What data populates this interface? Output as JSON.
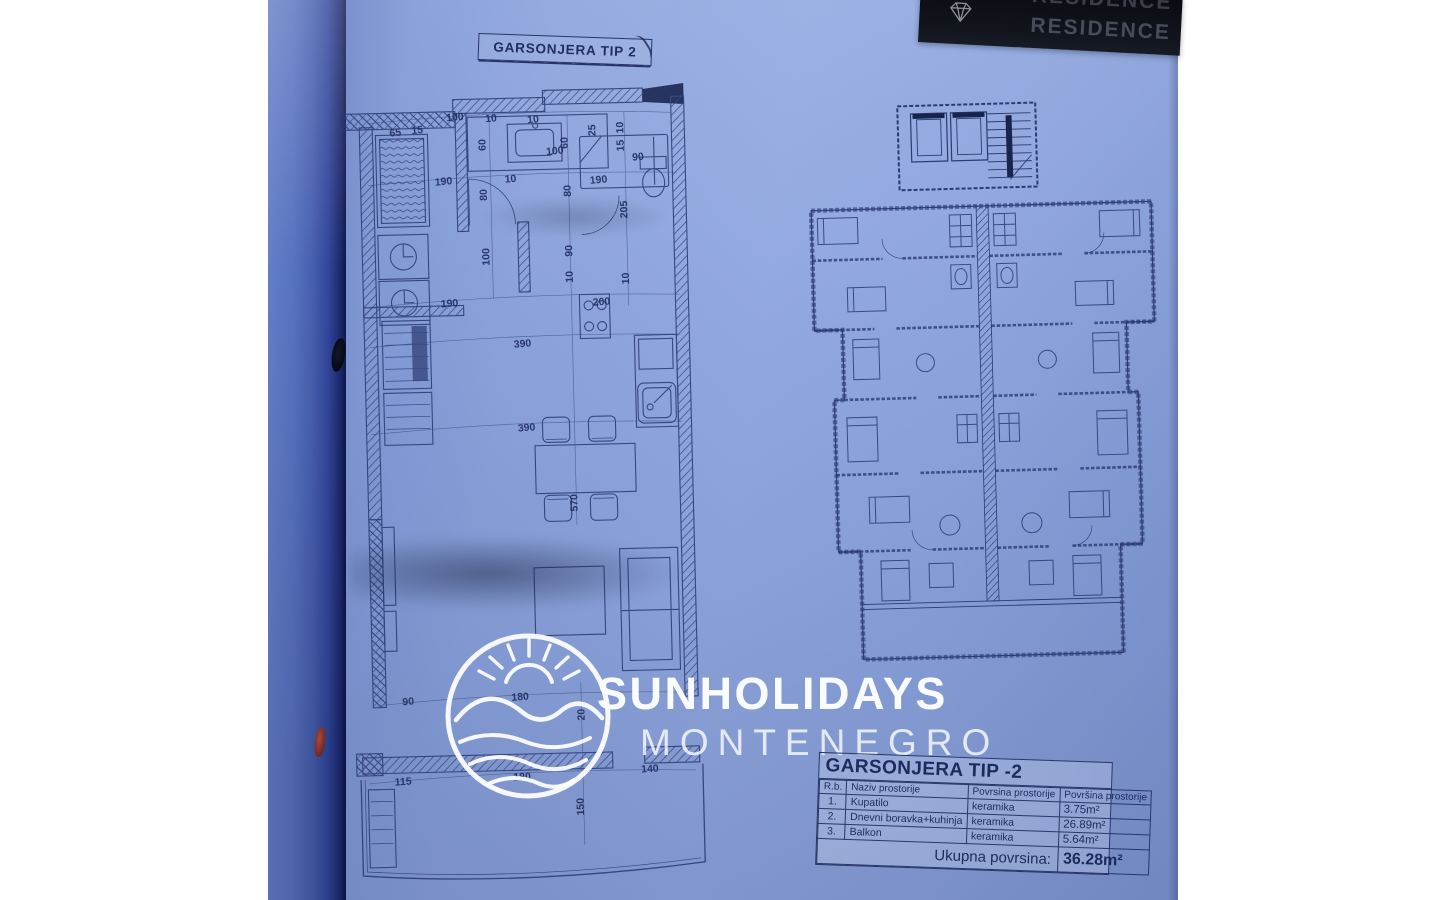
{
  "colors": {
    "page_blue": "#8aa2dc",
    "ink": "#2c3b72",
    "spine_dark": "#0c143f",
    "banner_bg": "#0a0c11",
    "banner_text": "#464c59",
    "watermark_white": "#ffffff",
    "red_mark": "#7c2a1d"
  },
  "banner": {
    "text": "RESIDENCE",
    "icon": "gem-icon"
  },
  "plan_title": {
    "text": "GARSONJERA TIP 2"
  },
  "watermark": {
    "line1": "SUNHOLIDAYS",
    "line2": "MONTENEGRO",
    "icon": "sun-over-hills-logo"
  },
  "left_plan": {
    "dims": [
      {
        "t": "65",
        "x": 56,
        "y": 44,
        "r": -4
      },
      {
        "t": "15",
        "x": 78,
        "y": 42,
        "r": -4
      },
      {
        "t": "100",
        "x": 116,
        "y": 30,
        "r": -4
      },
      {
        "t": "10",
        "x": 152,
        "y": 32,
        "r": -4
      },
      {
        "t": "60",
        "x": 143,
        "y": 58,
        "r": -90
      },
      {
        "t": "10",
        "x": 194,
        "y": 34,
        "r": -4
      },
      {
        "t": "60",
        "x": 225,
        "y": 58,
        "r": -90
      },
      {
        "t": "100",
        "x": 215,
        "y": 66,
        "r": -4
      },
      {
        "t": "25",
        "x": 253,
        "y": 46,
        "r": -90
      },
      {
        "t": "10",
        "x": 281,
        "y": 44,
        "r": -90
      },
      {
        "t": "15",
        "x": 281,
        "y": 62,
        "r": -90
      },
      {
        "t": "90",
        "x": 298,
        "y": 74,
        "r": -4
      },
      {
        "t": "190",
        "x": 103,
        "y": 94,
        "r": -4
      },
      {
        "t": "80",
        "x": 143,
        "y": 108,
        "r": -90
      },
      {
        "t": "10",
        "x": 170,
        "y": 93,
        "r": -4
      },
      {
        "t": "80",
        "x": 227,
        "y": 106,
        "r": -90
      },
      {
        "t": "190",
        "x": 258,
        "y": 96,
        "r": -4
      },
      {
        "t": "205",
        "x": 283,
        "y": 126,
        "r": -90
      },
      {
        "t": "100",
        "x": 144,
        "y": 170,
        "r": -90
      },
      {
        "t": "90",
        "x": 227,
        "y": 166,
        "r": -90
      },
      {
        "t": "10",
        "x": 227,
        "y": 192,
        "r": -90
      },
      {
        "t": "10",
        "x": 283,
        "y": 195,
        "r": -90
      },
      {
        "t": "190",
        "x": 106,
        "y": 216,
        "r": -3
      },
      {
        "t": "200",
        "x": 258,
        "y": 218,
        "r": -3
      },
      {
        "t": "390",
        "x": 178,
        "y": 258,
        "r": -3
      },
      {
        "t": "390",
        "x": 180,
        "y": 342,
        "r": -3
      },
      {
        "t": "570",
        "x": 226,
        "y": 418,
        "r": -90
      },
      {
        "t": "90",
        "x": 55,
        "y": 613,
        "r": -3
      },
      {
        "t": "180",
        "x": 167,
        "y": 611,
        "r": -3
      },
      {
        "t": "20",
        "x": 228,
        "y": 630,
        "r": -90
      },
      {
        "t": "115",
        "x": 48,
        "y": 693,
        "r": -2
      },
      {
        "t": "180",
        "x": 167,
        "y": 691,
        "r": -2
      },
      {
        "t": "140",
        "x": 295,
        "y": 686,
        "r": -2
      },
      {
        "t": "150",
        "x": 225,
        "y": 722,
        "r": -90
      }
    ]
  },
  "spec_table": {
    "title": "GARSONJERA TIP -2",
    "headers": [
      "R.b.",
      "Naziv prostorije",
      "Povrsina prostorije",
      "Površina prostorije"
    ],
    "rows": [
      [
        "1.",
        "Kupatilo",
        "keramika",
        "3.75m²"
      ],
      [
        "2.",
        "Dnevni boravka+kuhinja",
        "keramika",
        "26.89m²"
      ],
      [
        "3.",
        "Balkon",
        "keramika",
        "5.64m²"
      ]
    ],
    "total_label": "Ukupna povrsina:",
    "total_value": "36.28m²"
  }
}
